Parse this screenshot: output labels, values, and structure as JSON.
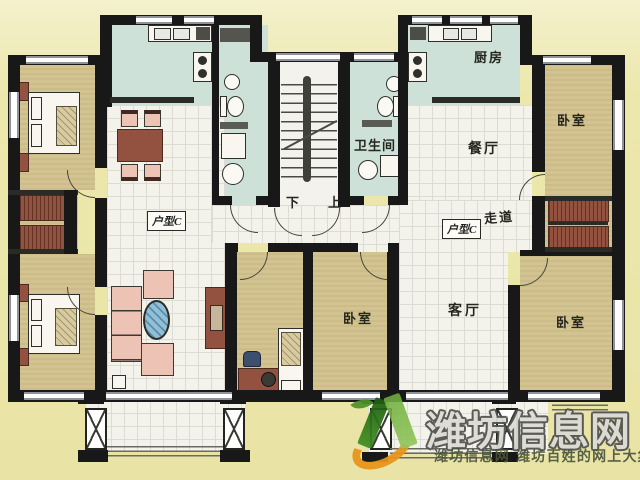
{
  "plan": {
    "labels": {
      "unit_type": "户型C",
      "kitchen": "厨房",
      "bathroom": "卫生间",
      "dining": "餐厅",
      "living": "客厅",
      "bedroom": "卧室",
      "hallway": "走道",
      "stairs_down": "下",
      "stairs_up": "上"
    }
  },
  "watermark": {
    "site_name": "潍坊信息网",
    "tagline": "潍坊信息网 潍坊百姓的网上大集"
  },
  "colors": {
    "background": "#ece7ad",
    "wall": "#181818",
    "floor_bedroom_tan": "#d2c390",
    "floor_kitchen_teal": "#cde1d8",
    "floor_grid_white": "#f4f3eb",
    "furniture_brown": "#92523f",
    "sofa_pink": "#ecc3b4",
    "coffee_table_blue": "#8fc0da",
    "logo_green": "#4c9427",
    "logo_orange": "#e79418",
    "watermark_text": "#dcdbd6"
  }
}
